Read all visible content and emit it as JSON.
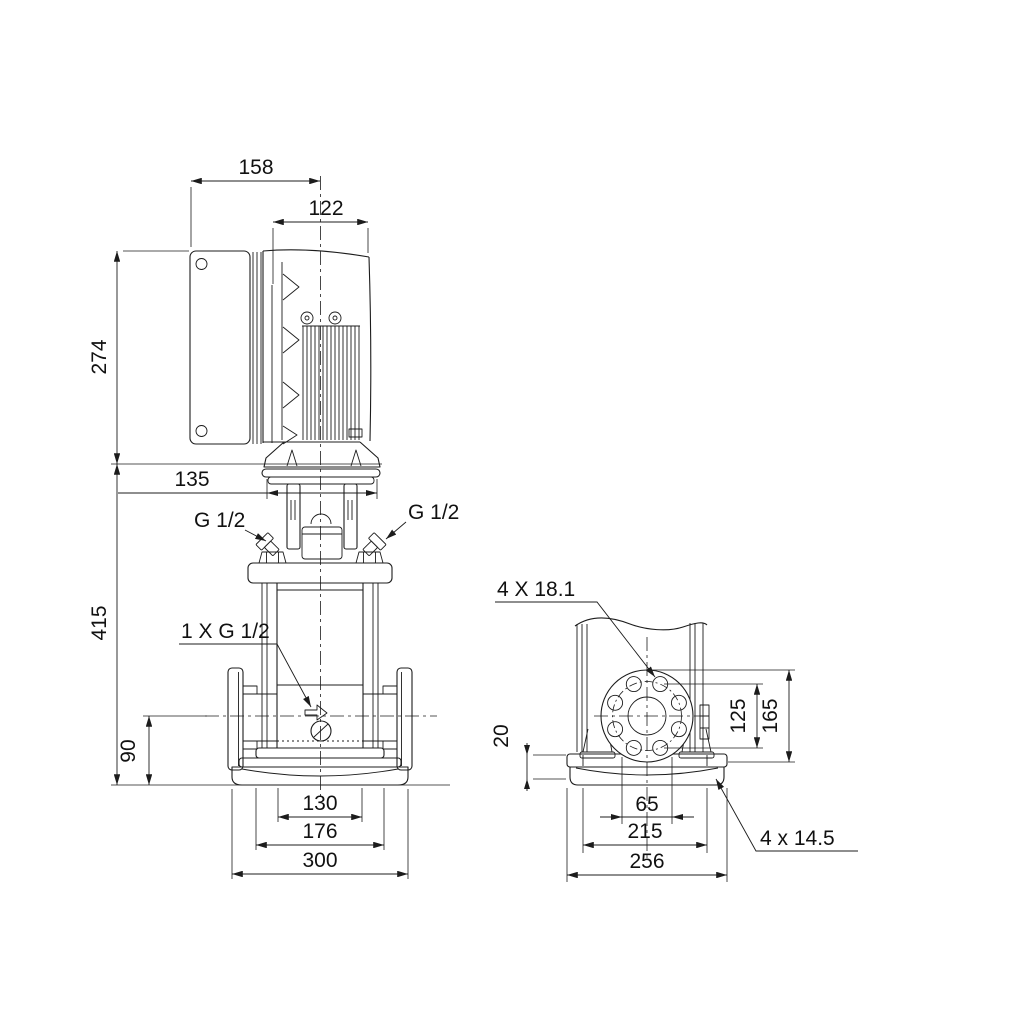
{
  "colors": {
    "ink": "#1c1c1c",
    "paper": "#ffffff"
  },
  "left_view": {
    "overall_width": "158",
    "motor_width": "122",
    "drive_height": "274",
    "coupling_width": "135",
    "pump_height": "415",
    "port_height": "90",
    "sleeve_width": "130",
    "base_step_width": "176",
    "base_width": "300",
    "left_gauge_port": "G 1/2",
    "right_gauge_port": "G 1/2",
    "drain_port": "1 X G 1/2"
  },
  "right_view": {
    "flange_bolt_holes": "4 X 18.1",
    "bolt_circle_diameter": "125",
    "flange_diameter": "165",
    "base_plate_height": "20",
    "center_spacing": "65",
    "base_bolt_spacing": "215",
    "base_depth": "256",
    "foundation_holes": "4 x 14.5"
  }
}
